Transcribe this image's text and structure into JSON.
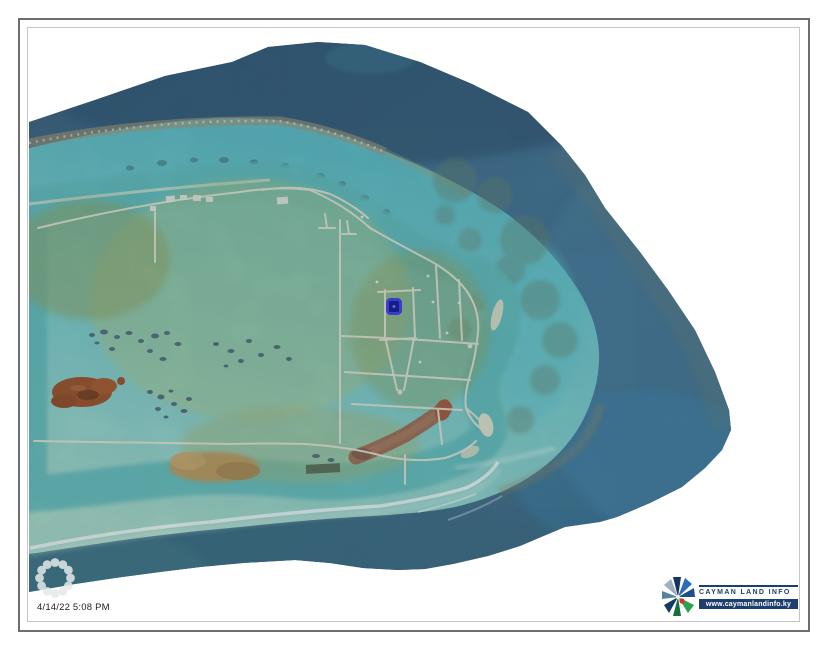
{
  "footer": {
    "timestamp": "4/14/22 5:08 PM"
  },
  "branding": {
    "name": "CAYMAN LAND INFO",
    "website": "www.caymanlandinfo.ky",
    "navy_color": "#1d3f70"
  },
  "map": {
    "selected_parcel_color": "#2e2ef0",
    "deep_water_color": "#32607f",
    "shallow_water_color": "#6ac6c8",
    "land_color": "#9dab58",
    "sand_color": "#dcd5b5",
    "road_color": "#ebe5d1",
    "icons": {
      "spinner": "loading-spinner-icon",
      "brand_mark": "cayman-land-info-starburst-icon"
    }
  }
}
